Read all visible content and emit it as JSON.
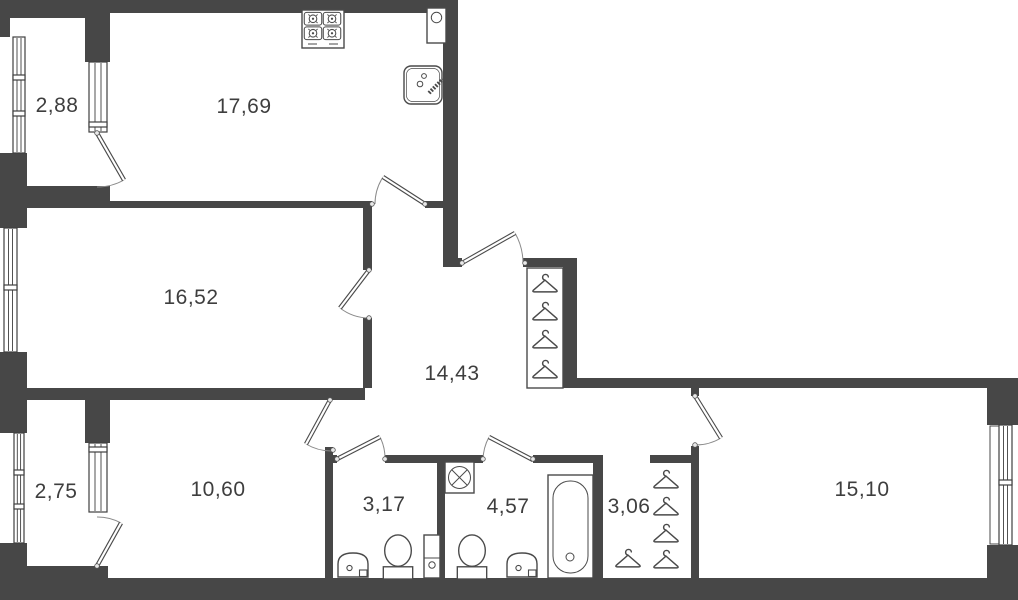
{
  "plan": {
    "kind": "apartment-floor-plan",
    "rooms": [
      {
        "id": "balcony-top-left",
        "area": "2,88"
      },
      {
        "id": "kitchen",
        "area": "17,69"
      },
      {
        "id": "living-room",
        "area": "16,52"
      },
      {
        "id": "hallway",
        "area": "14,43"
      },
      {
        "id": "balcony-bottom-left",
        "area": "2,75"
      },
      {
        "id": "bedroom-left",
        "area": "10,60"
      },
      {
        "id": "wc",
        "area": "3,17"
      },
      {
        "id": "bathroom",
        "area": "4,57"
      },
      {
        "id": "closet",
        "area": "3,06"
      },
      {
        "id": "bedroom-right",
        "area": "15,10"
      }
    ],
    "colors": {
      "wall": "#474747",
      "line": "#4a4a4a",
      "background": "#ffffff",
      "label": "#3e3e3e"
    },
    "icons": [
      "stove-icon",
      "kitchen-sink-icon",
      "boiler-icon",
      "washing-machine-icon",
      "toilet-icon",
      "bathroom-sink-icon",
      "bathtub-icon",
      "plumbing-riser-icon",
      "hanger-icon",
      "window-icon",
      "door-icon"
    ]
  }
}
